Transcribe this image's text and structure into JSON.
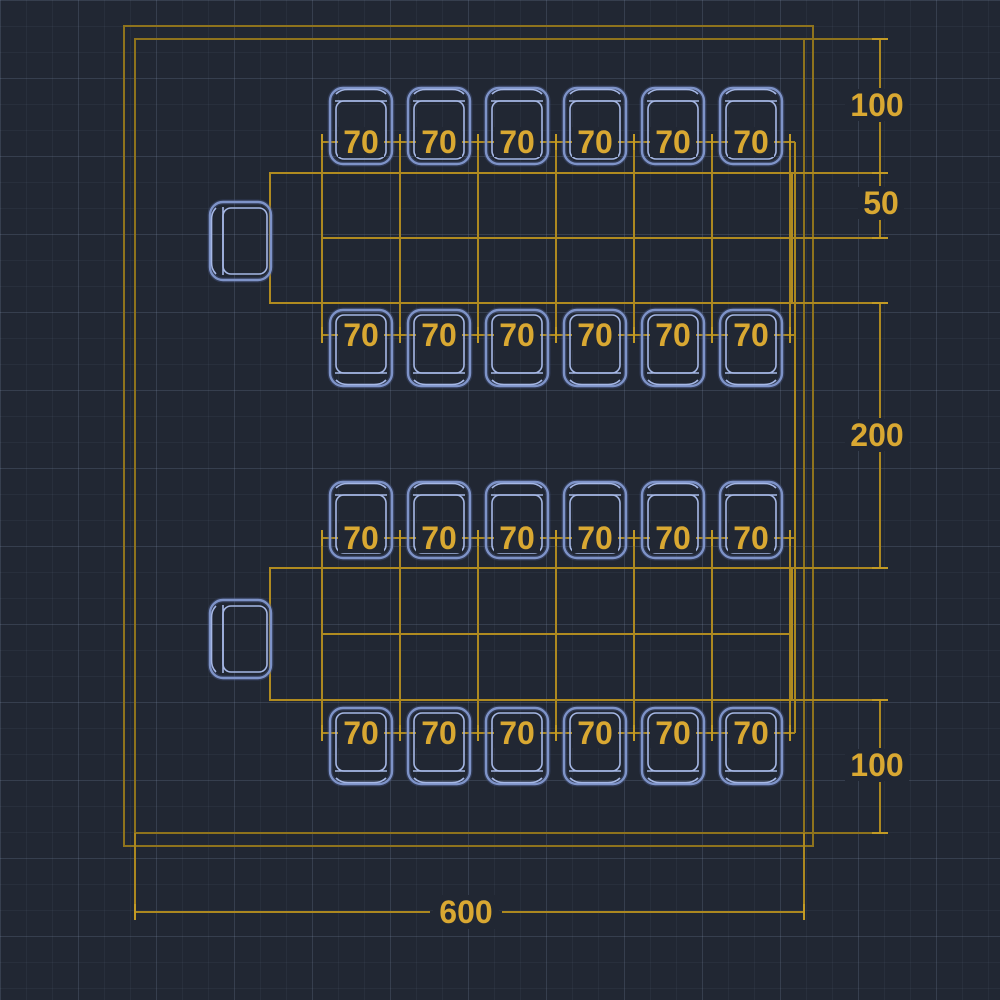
{
  "drawing": {
    "title": "table-and-chairs-dimension-plan",
    "background_color": "#212733",
    "frame_line_color": "#8e731d",
    "entity_line_color": "#b08b20",
    "dimension_text_color": "#d9a832",
    "chair_line_color": "#8ca1d8"
  },
  "labels": {
    "seat_rows": [
      {
        "id": "table1-top-row",
        "values": [
          "70",
          "70",
          "70",
          "70",
          "70",
          "70"
        ]
      },
      {
        "id": "table1-bottom-row",
        "values": [
          "70",
          "70",
          "70",
          "70",
          "70",
          "70"
        ]
      },
      {
        "id": "table2-top-row",
        "values": [
          "70",
          "70",
          "70",
          "70",
          "70",
          "70"
        ]
      },
      {
        "id": "table2-bottom-row",
        "values": [
          "70",
          "70",
          "70",
          "70",
          "70",
          "70"
        ]
      }
    ],
    "right_dims": [
      {
        "id": "top-margin",
        "value": "100"
      },
      {
        "id": "table-depth",
        "value": "50"
      },
      {
        "id": "table-gap",
        "value": "200"
      },
      {
        "id": "bottom-margin",
        "value": "100"
      }
    ],
    "bottom_dim": {
      "id": "overall-width",
      "value": "600"
    }
  }
}
